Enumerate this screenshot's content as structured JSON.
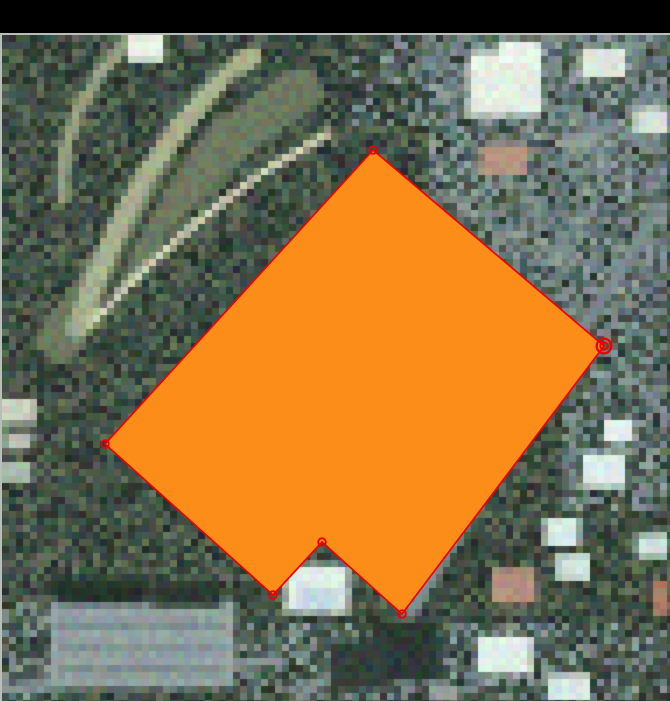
{
  "window": {
    "background_color": "#000000",
    "top_bar_height": 33,
    "map_frame_border_color": "#b9beb9"
  },
  "map": {
    "feature_polygon": {
      "fill": "#fc8d19",
      "stroke": "#f20000",
      "stroke_width": 1.7,
      "vertices": [
        [
          373,
          150
        ],
        [
          604,
          346
        ],
        [
          402,
          614
        ],
        [
          322,
          542
        ],
        [
          273,
          595
        ],
        [
          105,
          444
        ]
      ],
      "selected_vertex_index": 1
    },
    "vertex_marker": {
      "color": "#ee0000",
      "radius": 3.8,
      "stroke_width": 1.8
    },
    "selected_vertex_marker": {
      "color": "#ee0000",
      "outer_radius": 7.3,
      "outer_stroke_width": 2.3,
      "center_dot_radius": 1.2
    },
    "imagery": {
      "pixel_size": 7,
      "seed": 1234,
      "jitter": 26,
      "palettes": {
        "vegetation": [
          "#2f3d36",
          "#3a4a40",
          "#46564a",
          "#536350",
          "#5f6e58",
          "#2a362f",
          "#44524a",
          "#3d4d44"
        ],
        "urban": [
          "#566a69",
          "#657877",
          "#748584",
          "#82918f",
          "#8f9e9c",
          "#4a5e5c",
          "#6b7d7e",
          "#7a8a88"
        ]
      },
      "regions": [
        {
          "x": 430,
          "y": 33,
          "w": 240,
          "h": 270,
          "mix": 0.8,
          "palette": "urban"
        },
        {
          "x": 560,
          "y": 300,
          "w": 110,
          "h": 210,
          "mix": 0.55,
          "palette": "urban"
        },
        {
          "x": 240,
          "y": 620,
          "w": 430,
          "h": 81,
          "mix": 0.45,
          "palette": "urban"
        },
        {
          "x": 0,
          "y": 600,
          "w": 60,
          "h": 101,
          "mix": 0.4,
          "palette": "urban"
        },
        {
          "x": 350,
          "y": 33,
          "w": 90,
          "h": 90,
          "mix": 0.3,
          "palette": "urban"
        }
      ],
      "bands": [
        {
          "pts": [
            [
              300,
              90
            ],
            [
              170,
              170
            ],
            [
              60,
              340
            ]
          ],
          "w": 46,
          "c": "#6d7a60"
        },
        {
          "pts": [
            [
              252,
              56
            ],
            [
              140,
              140
            ],
            [
              77,
              329
            ]
          ],
          "w": 20,
          "c": "#a9b190"
        },
        {
          "pts": [
            [
              329,
              133
            ],
            [
              210,
              196
            ],
            [
              91,
              322
            ]
          ],
          "w": 9,
          "c": "#d4d7bb"
        },
        {
          "pts": [
            [
              133,
              35
            ],
            [
              56,
              112
            ],
            [
              63,
              196
            ]
          ],
          "w": 13,
          "c": "#98a284"
        },
        {
          "pts": [
            [
              238,
              76
            ],
            [
              150,
              190
            ],
            [
              105,
              305
            ]
          ],
          "w": 5,
          "c": "#222e28"
        },
        {
          "pts": [
            [
              658,
              210
            ],
            [
              520,
              420
            ],
            [
              399,
              630
            ]
          ],
          "w": 15,
          "c": "#7c8c8e"
        },
        {
          "pts": [
            [
              399,
              630
            ],
            [
              350,
              664
            ],
            [
              300,
              696
            ]
          ],
          "w": 13,
          "c": "#81908f"
        },
        {
          "pts": [
            [
              420,
              56
            ],
            [
              540,
              100
            ],
            [
              660,
              150
            ]
          ],
          "w": 9,
          "c": "#7f8f8f"
        },
        {
          "pts": [
            [
              0,
              690
            ],
            [
              140,
              678
            ],
            [
              280,
              660
            ]
          ],
          "w": 10,
          "c": "#8a9896"
        },
        {
          "pts": [
            [
              610,
              350
            ],
            [
              640,
              386
            ],
            [
              670,
              420
            ]
          ],
          "w": 8,
          "c": "#8a9a98"
        }
      ],
      "blobs": [
        {
          "x": 50,
          "y": 600,
          "w": 185,
          "h": 88,
          "c": "#93a3a2"
        },
        {
          "x": 55,
          "y": 622,
          "w": 170,
          "h": 6,
          "c": "#75868a"
        },
        {
          "x": 60,
          "y": 646,
          "w": 165,
          "h": 6,
          "c": "#7b8c8e"
        },
        {
          "x": 58,
          "y": 668,
          "w": 168,
          "h": 5,
          "c": "#718284"
        },
        {
          "x": 55,
          "y": 578,
          "w": 92,
          "h": 26,
          "c": "#26332c"
        },
        {
          "x": 152,
          "y": 583,
          "w": 70,
          "h": 24,
          "c": "#2b3830"
        },
        {
          "x": 285,
          "y": 565,
          "w": 64,
          "h": 48,
          "c": "#dcebe6"
        },
        {
          "x": 300,
          "y": 588,
          "w": 40,
          "h": 22,
          "c": "#c2dade"
        },
        {
          "x": 468,
          "y": 52,
          "w": 74,
          "h": 64,
          "c": "#e4efe2"
        },
        {
          "x": 500,
          "y": 40,
          "w": 40,
          "h": 22,
          "c": "#eef6ee"
        },
        {
          "x": 580,
          "y": 48,
          "w": 46,
          "h": 30,
          "c": "#dde8dc"
        },
        {
          "x": 634,
          "y": 108,
          "w": 36,
          "h": 26,
          "c": "#d7e3d9"
        },
        {
          "x": 480,
          "y": 145,
          "w": 48,
          "h": 30,
          "c": "#b59482"
        },
        {
          "x": 560,
          "y": 130,
          "w": 36,
          "h": 22,
          "c": "#8c9a96"
        },
        {
          "x": 582,
          "y": 452,
          "w": 44,
          "h": 36,
          "c": "#def0ea"
        },
        {
          "x": 544,
          "y": 518,
          "w": 36,
          "h": 28,
          "c": "#d8ebe4"
        },
        {
          "x": 556,
          "y": 554,
          "w": 34,
          "h": 26,
          "c": "#d4e8e0"
        },
        {
          "x": 636,
          "y": 534,
          "w": 32,
          "h": 24,
          "c": "#cfe2da"
        },
        {
          "x": 604,
          "y": 420,
          "w": 30,
          "h": 22,
          "c": "#e6f2ec"
        },
        {
          "x": 492,
          "y": 568,
          "w": 44,
          "h": 36,
          "c": "#b49180"
        },
        {
          "x": 652,
          "y": 580,
          "w": 18,
          "h": 36,
          "c": "#a87a62"
        },
        {
          "x": 478,
          "y": 636,
          "w": 54,
          "h": 38,
          "c": "#e2f0e8"
        },
        {
          "x": 548,
          "y": 674,
          "w": 42,
          "h": 26,
          "c": "#d8e8e0"
        },
        {
          "x": 430,
          "y": 686,
          "w": 30,
          "h": 15,
          "c": "#9aa89f"
        },
        {
          "x": 0,
          "y": 398,
          "w": 36,
          "h": 26,
          "c": "#c8d2c2"
        },
        {
          "x": 4,
          "y": 432,
          "w": 28,
          "h": 18,
          "c": "#b7c2b2"
        },
        {
          "x": 0,
          "y": 462,
          "w": 32,
          "h": 20,
          "c": "#aebdb0"
        },
        {
          "x": 128,
          "y": 34,
          "w": 36,
          "h": 28,
          "c": "#e8f2e6"
        },
        {
          "x": 370,
          "y": 620,
          "w": 70,
          "h": 60,
          "c": "#2c3a34"
        },
        {
          "x": 330,
          "y": 640,
          "w": 60,
          "h": 50,
          "c": "#31403c"
        }
      ]
    }
  }
}
